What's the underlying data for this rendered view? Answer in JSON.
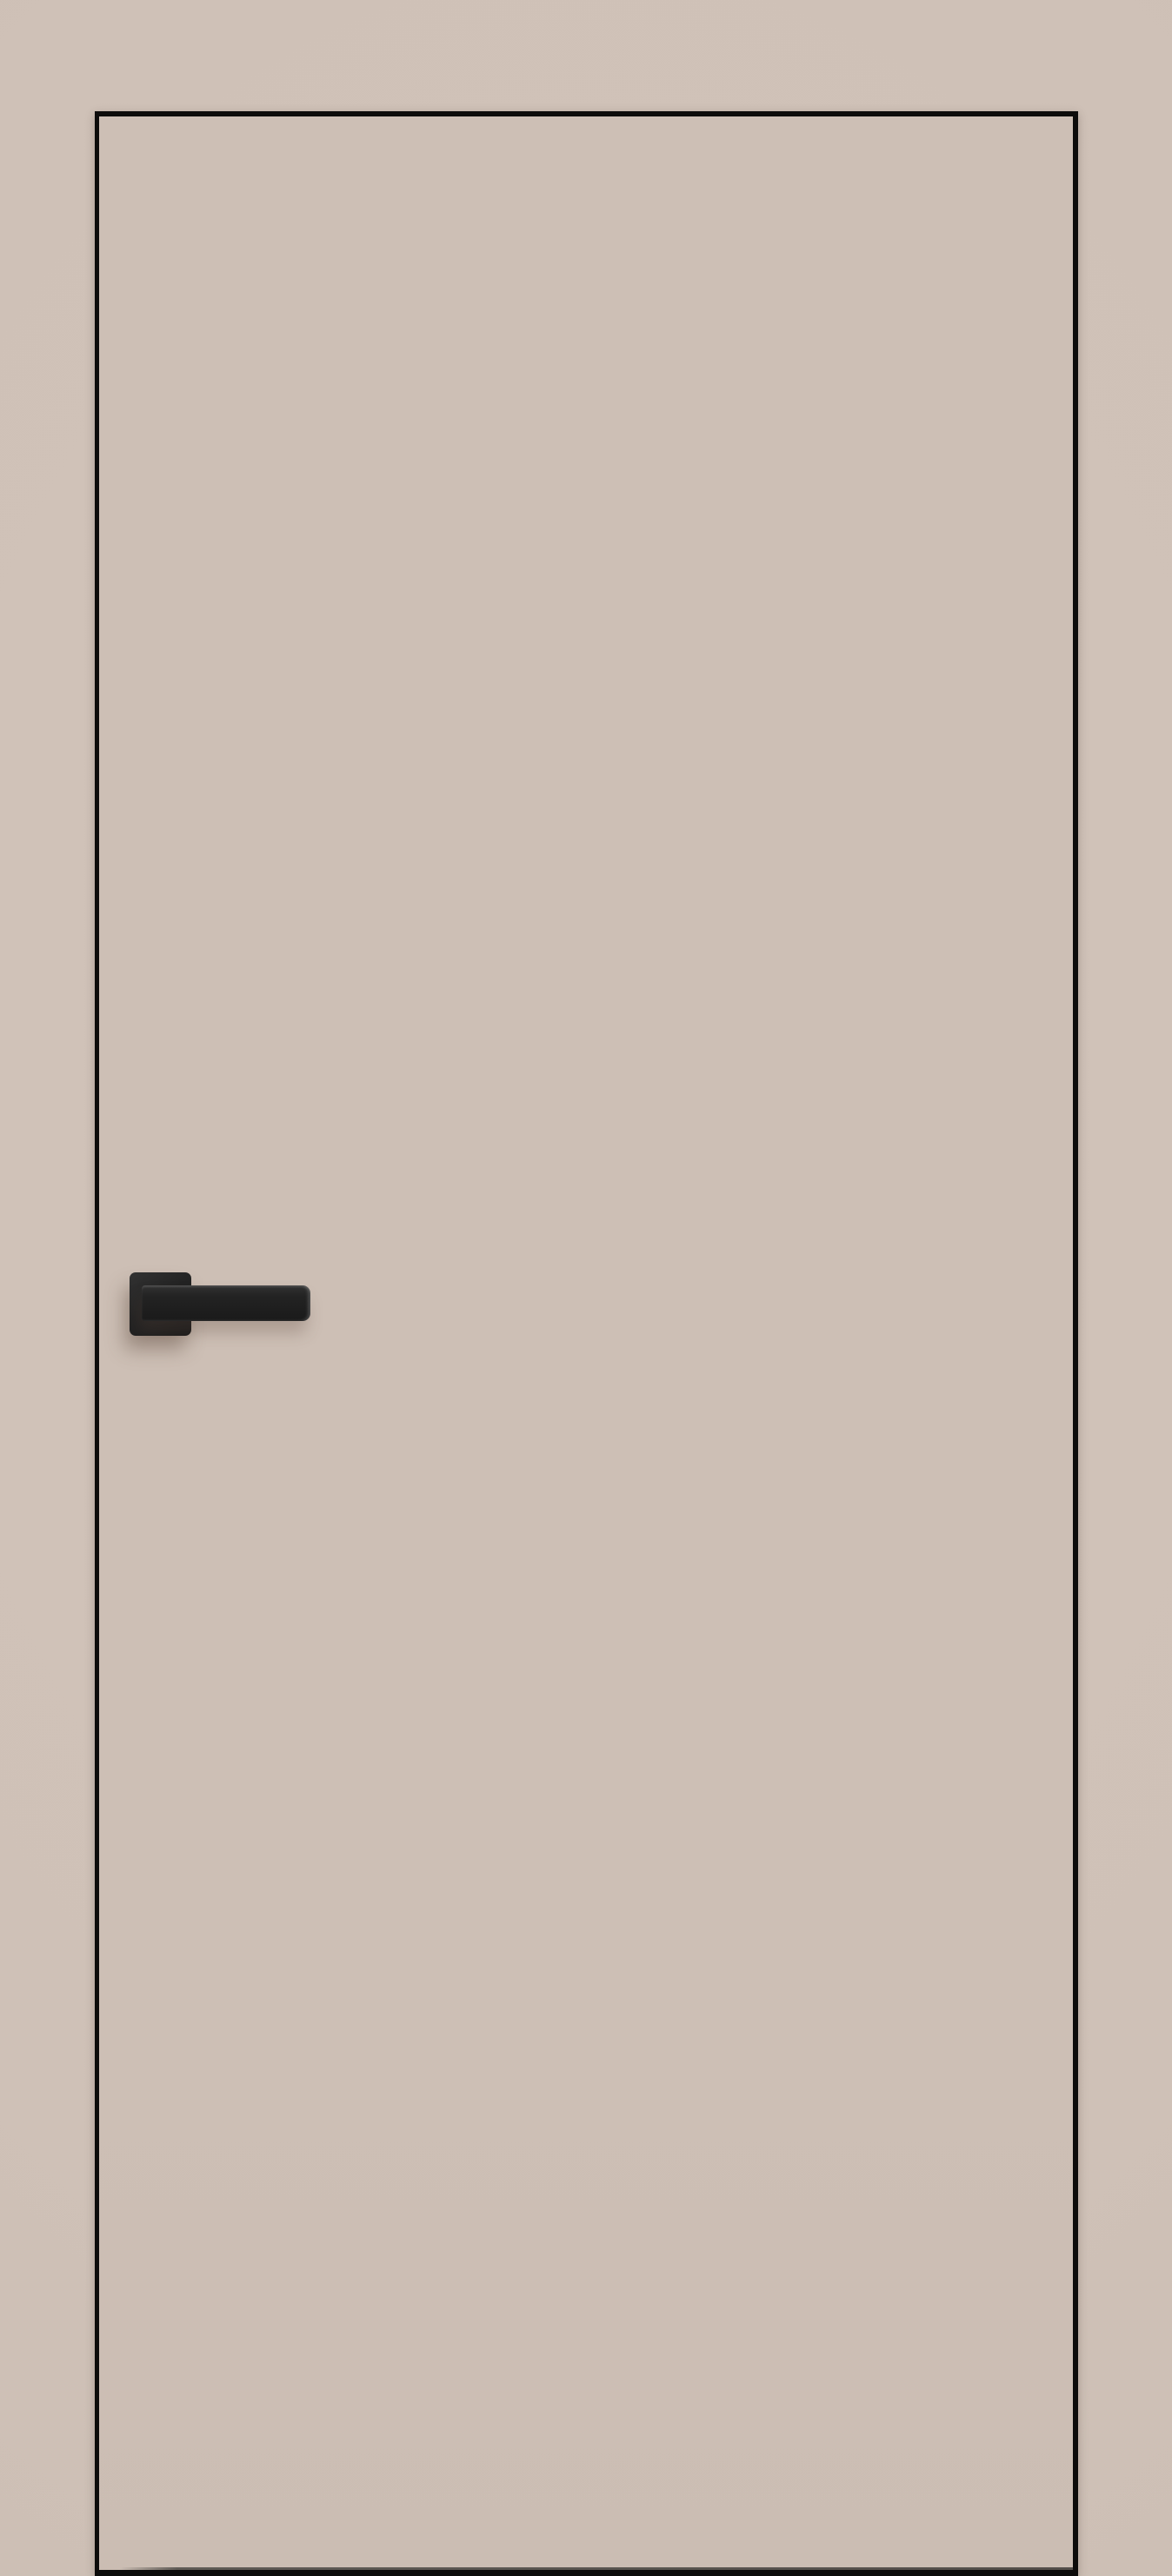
{
  "scene": {
    "subject": "interior-door-product-render",
    "parts": [
      "wall-background",
      "door-leaf",
      "door-edge-trim",
      "handle-rosette",
      "handle-lever",
      "floor-gap-shadow"
    ]
  },
  "colors": {
    "wall": "#cfc1b7",
    "wall_light": "#d1c3b9",
    "wall_dark": "#cabcb2",
    "door_face": "#cdbfb5",
    "door_face_dark": "#cbbdb3",
    "door_edge": "#0d0c0b",
    "handle_light": "#323232",
    "handle_mid": "#232323",
    "handle_dark": "#1a1a1a",
    "gap_shadow": "#5f5a55"
  }
}
